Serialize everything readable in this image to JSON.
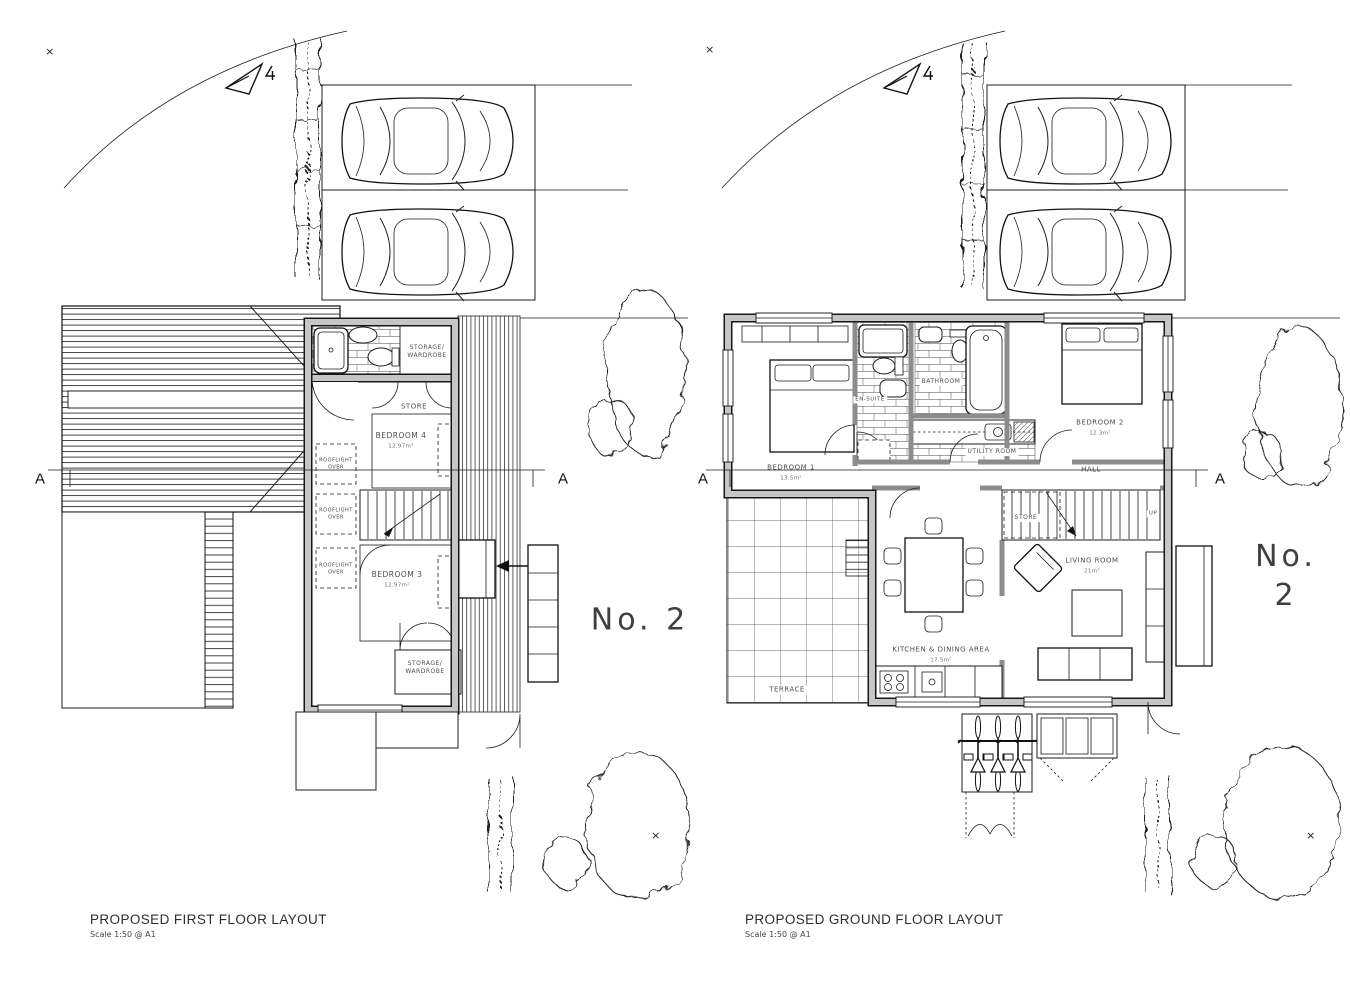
{
  "symbols": {
    "survey_mark": "×"
  },
  "icons": {
    "north_arrow": "triangle-north-arrow",
    "car": "car-top-view",
    "bicycle": "bicycle-top-view",
    "tree": "scribbled-tree-outline",
    "hedge": "hedge-strip"
  },
  "first_floor": {
    "title": "PROPOSED FIRST FLOOR LAYOUT",
    "scale_note": "Scale 1:50 @ A1",
    "house_number": "No. 2",
    "section_marker": "A",
    "rooms": {
      "storage_wardrobe_top": "STORAGE/\nWARDROBE",
      "store": "STORE",
      "bedroom4": {
        "name": "BEDROOM 4",
        "area": "12.97m²"
      },
      "bedroom3": {
        "name": "BEDROOM 3",
        "area": "12.97m²"
      },
      "rooflight": "ROOFLIGHT\nOVER",
      "storage_wardrobe_bottom": "STORAGE/\nWARDROBE"
    }
  },
  "ground_floor": {
    "title": "PROPOSED GROUND FLOOR LAYOUT",
    "scale_note": "Scale 1:50 @ A1",
    "house_number": "No. 2",
    "section_marker": "A",
    "rooms": {
      "bedroom1": {
        "name": "BEDROOM 1",
        "area": "13.5m²"
      },
      "en_suite": "EN-SUITE",
      "bathroom": "BATHROOM",
      "utility": "UTILITY ROOM",
      "bedroom2": {
        "name": "BEDROOM 2",
        "area": "12.3m²"
      },
      "hall": "HALL",
      "store": "STORE",
      "up": "UP",
      "kitchen_dining": {
        "name": "KITCHEN & DINING AREA",
        "area": "17.5m²"
      },
      "living": {
        "name": "LIVING ROOM",
        "area": "21m²"
      },
      "terrace": "TERRACE"
    }
  }
}
